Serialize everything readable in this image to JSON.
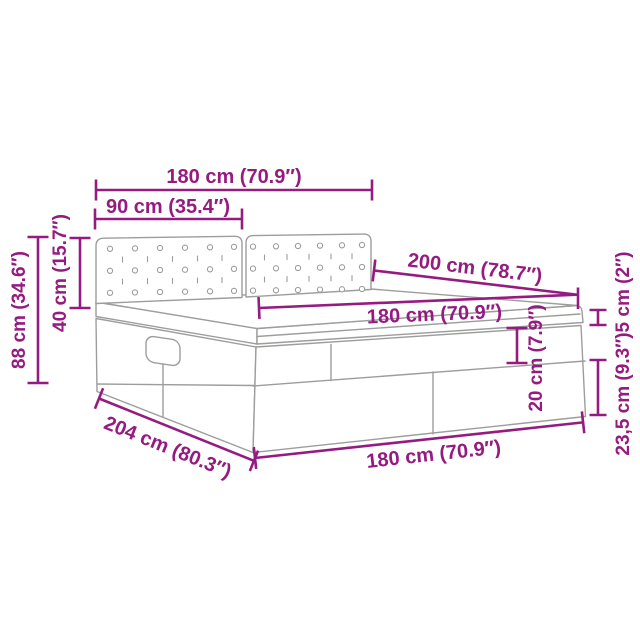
{
  "diagram": {
    "type": "product-dimension-diagram",
    "subject": "ottoman storage bed with tufted two-panel headboard, perspective line drawing",
    "colors": {
      "dimension": "#951B81",
      "drawing": "#9d9d9c",
      "background": "#ffffff"
    },
    "dims": {
      "headboard_width": "180 cm (70.9″)",
      "panel_width": "90 cm (35.4″)",
      "bed_length": "200 cm (78.7″)",
      "mattress_width": "180 cm (70.9″)",
      "headboard_height": "40 cm (15.7″)",
      "total_height": "88 cm (34.6″)",
      "topper_thickness": "5 cm (2″)",
      "frame_upper_height": "20 cm (7.9″)",
      "frame_lower_height": "23,5 cm (9.3″)",
      "total_length": "204 cm (80.3″)",
      "base_width": "180 cm (70.9″)"
    }
  }
}
